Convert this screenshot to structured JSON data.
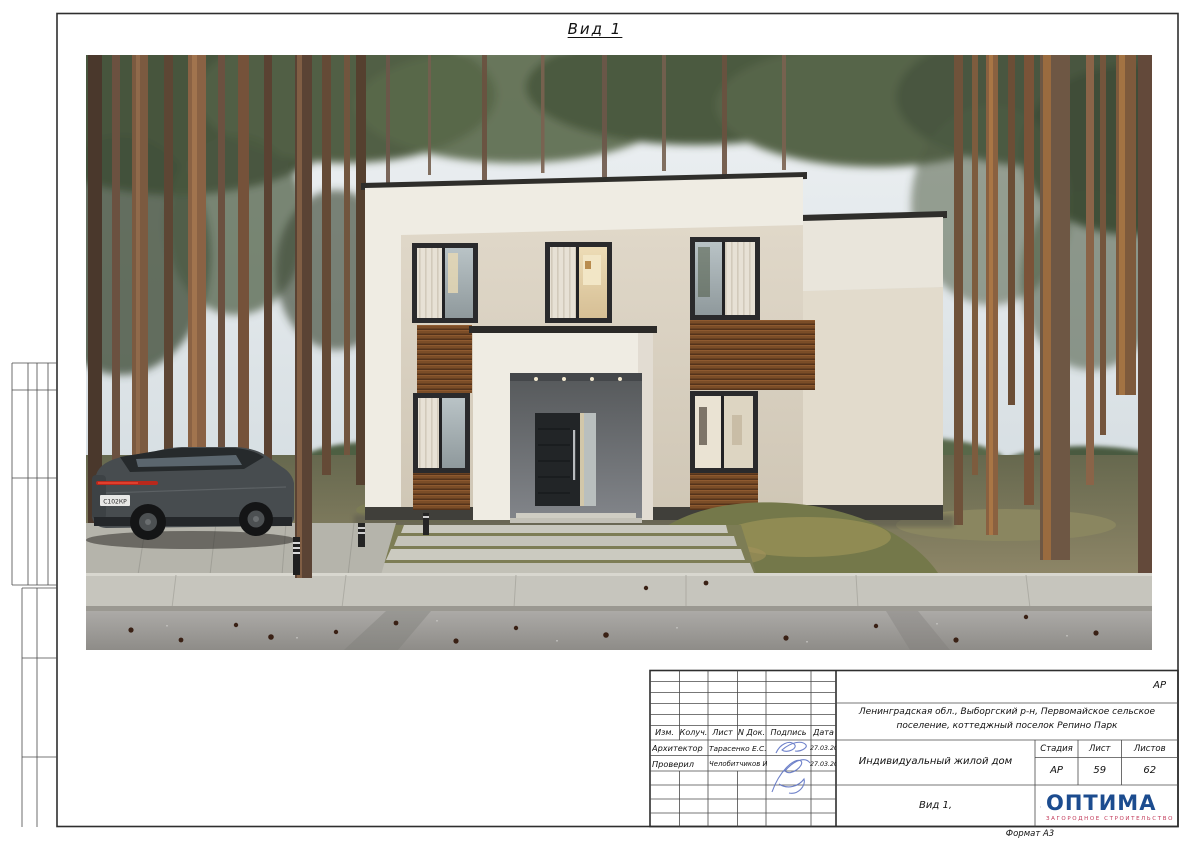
{
  "sheet": {
    "view_title": "Вид 1",
    "format_label": "Формат А3",
    "code": "АР"
  },
  "title_block": {
    "header": {
      "izm": "Изм.",
      "koluch": "Колуч.",
      "list": "Лист",
      "ndok": "N Док.",
      "podpis": "Подпись",
      "data_col": "Дата"
    },
    "rows": [
      {
        "role": "Архитектор",
        "name": "Тарасенко Е.С.",
        "date": "27.03.2026"
      },
      {
        "role": "Проверил",
        "name": "Челобитчиков И.С.",
        "date": "27.03.2026"
      }
    ],
    "location_line": "Ленинградская обл., Выборгский р-н, Первомайское сельское поселение, коттеджный поселок Репино Парк",
    "object_name": "Индивидуальный жилой дом",
    "stage": {
      "label_stage": "Стадия",
      "label_sheet": "Лист",
      "label_sheets": "Листов",
      "stage": "АР",
      "sheet": "59",
      "sheets": "62"
    },
    "view_label": "Вид 1,",
    "logo": {
      "name": "ОПТИМА",
      "tagline": "ЗАГОРОДНОЕ СТРОИТЕЛЬСТВО"
    }
  },
  "photo": {
    "car_plate": "С102КР"
  },
  "colors": {
    "frame_line": "#3c3c3c",
    "logo_blue": "#1c4c8f",
    "logo_red": "#c23a5a",
    "signature_blue": "#5f74c4",
    "wall_white": "#efece3",
    "wall_beige": "#d9d1c2",
    "wood_accent": "#7b4d27",
    "portal_grey": "#75787a"
  }
}
